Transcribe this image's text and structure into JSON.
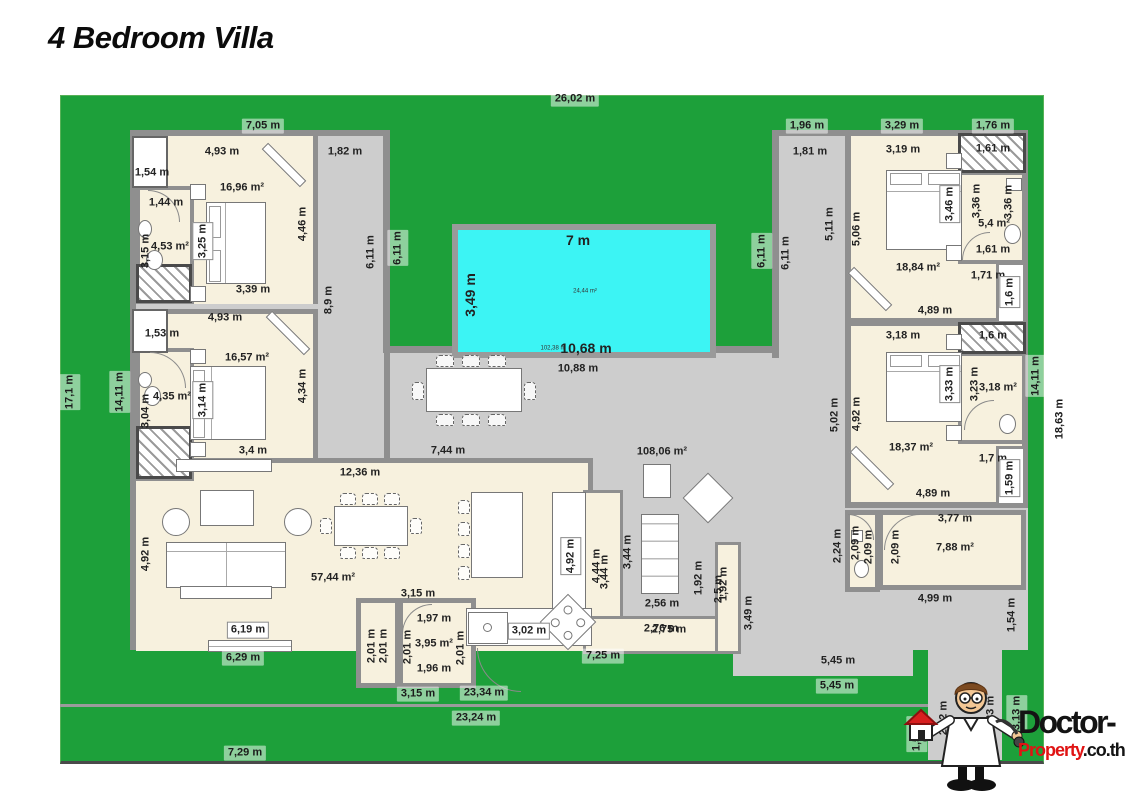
{
  "title": "4 Bedroom Villa",
  "logo": {
    "line1": "Doctor-",
    "line2_red": "Property",
    "line2_black": ".co.th"
  },
  "colors": {
    "garden": "#1da03a",
    "pool": "#3cf4f4",
    "wall": "#8f8f8f",
    "floor": "#f7f1de",
    "deck": "#cdcdcd",
    "logo_red": "#e01313"
  },
  "labels": [
    {
      "t": "26,02 m",
      "x": 575,
      "y": 99,
      "s": "chip"
    },
    {
      "t": "7,05 m",
      "x": 263,
      "y": 126,
      "s": "chip"
    },
    {
      "t": "1,96 m",
      "x": 807,
      "y": 126,
      "s": "chip"
    },
    {
      "t": "3,29 m",
      "x": 902,
      "y": 126,
      "s": "chip"
    },
    {
      "t": "1,76 m",
      "x": 993,
      "y": 126,
      "s": "chip"
    },
    {
      "t": "4,93 m",
      "x": 222,
      "y": 152
    },
    {
      "t": "1,82 m",
      "x": 345,
      "y": 152
    },
    {
      "t": "1,54 m",
      "x": 152,
      "y": 173
    },
    {
      "t": "3,19 m",
      "x": 903,
      "y": 150
    },
    {
      "t": "1,61 m",
      "x": 993,
      "y": 149
    },
    {
      "t": "1,81 m",
      "x": 810,
      "y": 152
    },
    {
      "t": "1,44 m",
      "x": 166,
      "y": 203
    },
    {
      "t": "16,96 m²",
      "x": 242,
      "y": 188
    },
    {
      "t": "4,53 m²",
      "x": 170,
      "y": 247
    },
    {
      "t": "3,39 m",
      "x": 253,
      "y": 290
    },
    {
      "t": "18,84 m²",
      "x": 918,
      "y": 268
    },
    {
      "t": "5,4 m²",
      "x": 994,
      "y": 224
    },
    {
      "t": "1,61 m",
      "x": 993,
      "y": 250
    },
    {
      "t": "1,71 m",
      "x": 988,
      "y": 276
    },
    {
      "t": "7 m",
      "x": 578,
      "y": 240,
      "s": "pool"
    },
    {
      "t": "24,44 m²",
      "x": 585,
      "y": 292,
      "s": "tiny"
    },
    {
      "t": "102,38 m",
      "x": 553,
      "y": 349,
      "s": "tiny"
    },
    {
      "t": "10,68 m",
      "x": 586,
      "y": 348,
      "s": "pool"
    },
    {
      "t": "10,88 m",
      "x": 578,
      "y": 369
    },
    {
      "t": "4,93 m",
      "x": 225,
      "y": 318
    },
    {
      "t": "1,53 m",
      "x": 162,
      "y": 334
    },
    {
      "t": "16,57 m²",
      "x": 247,
      "y": 358
    },
    {
      "t": "4,35 m²",
      "x": 172,
      "y": 397
    },
    {
      "t": "3,18 m",
      "x": 903,
      "y": 336
    },
    {
      "t": "1,6 m",
      "x": 993,
      "y": 336
    },
    {
      "t": "3,18 m²",
      "x": 998,
      "y": 388
    },
    {
      "t": "3,4 m",
      "x": 253,
      "y": 451
    },
    {
      "t": "18,37 m²",
      "x": 911,
      "y": 448
    },
    {
      "t": "7,44 m",
      "x": 448,
      "y": 451
    },
    {
      "t": "108,06 m²",
      "x": 662,
      "y": 452
    },
    {
      "t": "1,7 m",
      "x": 993,
      "y": 459
    },
    {
      "t": "12,36 m",
      "x": 360,
      "y": 473
    },
    {
      "t": "4,89 m",
      "x": 935,
      "y": 311
    },
    {
      "t": "4,89 m",
      "x": 933,
      "y": 494
    },
    {
      "t": "57,44 m²",
      "x": 333,
      "y": 578
    },
    {
      "t": "3,77 m",
      "x": 955,
      "y": 519
    },
    {
      "t": "7,88 m²",
      "x": 955,
      "y": 548
    },
    {
      "t": "3,15 m",
      "x": 418,
      "y": 594
    },
    {
      "t": "1,97 m",
      "x": 434,
      "y": 619
    },
    {
      "t": "3,95 m²",
      "x": 434,
      "y": 644
    },
    {
      "t": "1,96 m",
      "x": 434,
      "y": 669
    },
    {
      "t": "3,02 m",
      "x": 529,
      "y": 631,
      "s": "box"
    },
    {
      "t": "2,56 m",
      "x": 662,
      "y": 604
    },
    {
      "t": "2,76 m",
      "x": 661,
      "y": 629
    },
    {
      "t": "2,75 m",
      "x": 669,
      "y": 630
    },
    {
      "t": "6,19 m",
      "x": 248,
      "y": 630,
      "s": "box"
    },
    {
      "t": "6,29 m",
      "x": 243,
      "y": 658,
      "s": "chip"
    },
    {
      "t": "4,99 m",
      "x": 935,
      "y": 599
    },
    {
      "t": "5,45 m",
      "x": 838,
      "y": 661
    },
    {
      "t": "5,45 m",
      "x": 837,
      "y": 686,
      "s": "chip"
    },
    {
      "t": "3,15 m",
      "x": 418,
      "y": 694,
      "s": "chip"
    },
    {
      "t": "23,34 m",
      "x": 484,
      "y": 693,
      "s": "chip"
    },
    {
      "t": "23,24 m",
      "x": 476,
      "y": 718,
      "s": "chip"
    },
    {
      "t": "7,25 m",
      "x": 603,
      "y": 656,
      "s": "chip"
    },
    {
      "t": "7,29 m",
      "x": 245,
      "y": 753,
      "s": "chip"
    },
    {
      "t": "17,1 m",
      "x": 70,
      "y": 392,
      "v": true,
      "s": "chip"
    },
    {
      "t": "14,11 m",
      "x": 120,
      "y": 392,
      "v": true,
      "s": "chip"
    },
    {
      "t": "3,15 m",
      "x": 146,
      "y": 251,
      "v": true
    },
    {
      "t": "3,25 m",
      "x": 203,
      "y": 241,
      "v": true,
      "s": "box"
    },
    {
      "t": "4,46 m",
      "x": 303,
      "y": 224,
      "v": true
    },
    {
      "t": "8,9 m",
      "x": 329,
      "y": 300,
      "v": true
    },
    {
      "t": "6,11 m",
      "x": 371,
      "y": 252,
      "v": true
    },
    {
      "t": "6,11 m",
      "x": 398,
      "y": 248,
      "v": true,
      "s": "chip"
    },
    {
      "t": "3,49 m",
      "x": 470,
      "y": 295,
      "v": true,
      "s": "pool"
    },
    {
      "t": "3,04 m",
      "x": 146,
      "y": 411,
      "v": true
    },
    {
      "t": "3,14 m",
      "x": 203,
      "y": 400,
      "v": true,
      "s": "box"
    },
    {
      "t": "4,34 m",
      "x": 303,
      "y": 386,
      "v": true
    },
    {
      "t": "4,92 m",
      "x": 146,
      "y": 554,
      "v": true
    },
    {
      "t": "4,92 m",
      "x": 571,
      "y": 556,
      "v": true,
      "s": "box"
    },
    {
      "t": "4,44 m",
      "x": 597,
      "y": 566,
      "v": true
    },
    {
      "t": "3,44 m",
      "x": 605,
      "y": 572,
      "v": true
    },
    {
      "t": "3,44 m",
      "x": 628,
      "y": 552,
      "v": true
    },
    {
      "t": "1,92 m",
      "x": 699,
      "y": 578,
      "v": true
    },
    {
      "t": "2,5 m",
      "x": 719,
      "y": 589,
      "v": true
    },
    {
      "t": "1,92 m",
      "x": 724,
      "y": 584,
      "v": true
    },
    {
      "t": "3,49 m",
      "x": 749,
      "y": 613,
      "v": true
    },
    {
      "t": "6,11 m",
      "x": 762,
      "y": 251,
      "v": true,
      "s": "chip"
    },
    {
      "t": "6,11 m",
      "x": 786,
      "y": 253,
      "v": true
    },
    {
      "t": "5,11 m",
      "x": 830,
      "y": 224,
      "v": true
    },
    {
      "t": "5,06 m",
      "x": 857,
      "y": 229,
      "v": true
    },
    {
      "t": "3,46 m",
      "x": 950,
      "y": 204,
      "v": true,
      "s": "box"
    },
    {
      "t": "3,36 m",
      "x": 977,
      "y": 201,
      "v": true
    },
    {
      "t": "3,36 m",
      "x": 1009,
      "y": 202,
      "v": true
    },
    {
      "t": "1,6 m",
      "x": 1010,
      "y": 292,
      "v": true,
      "s": "box"
    },
    {
      "t": "5,02 m",
      "x": 835,
      "y": 415,
      "v": true
    },
    {
      "t": "4,92 m",
      "x": 857,
      "y": 414,
      "v": true
    },
    {
      "t": "3,33 m",
      "x": 950,
      "y": 384,
      "v": true,
      "s": "box"
    },
    {
      "t": "3,23 m",
      "x": 975,
      "y": 384,
      "v": true
    },
    {
      "t": "14,11 m",
      "x": 1036,
      "y": 376,
      "v": true,
      "s": "chip"
    },
    {
      "t": "18,63 m",
      "x": 1060,
      "y": 419,
      "v": true,
      "s": "chip"
    },
    {
      "t": "1,59 m",
      "x": 1010,
      "y": 478,
      "v": true,
      "s": "box"
    },
    {
      "t": "2,24 m",
      "x": 838,
      "y": 546,
      "v": true
    },
    {
      "t": "2,09 m",
      "x": 856,
      "y": 543,
      "v": true
    },
    {
      "t": "2,09 m",
      "x": 869,
      "y": 547,
      "v": true
    },
    {
      "t": "2,09 m",
      "x": 896,
      "y": 547,
      "v": true
    },
    {
      "t": "2,01 m",
      "x": 372,
      "y": 646,
      "v": true
    },
    {
      "t": "2,01 m",
      "x": 384,
      "y": 646,
      "v": true
    },
    {
      "t": "2,01 m",
      "x": 408,
      "y": 647,
      "v": true
    },
    {
      "t": "2,01 m",
      "x": 461,
      "y": 648,
      "v": true
    },
    {
      "t": "1,54 m",
      "x": 1012,
      "y": 615,
      "v": true
    },
    {
      "t": "1,53 m",
      "x": 917,
      "y": 734,
      "v": true,
      "s": "chip"
    },
    {
      "t": "2,42 m",
      "x": 944,
      "y": 718,
      "v": true
    },
    {
      "t": "3,23 m",
      "x": 991,
      "y": 713,
      "v": true
    },
    {
      "t": "3,13 m",
      "x": 1017,
      "y": 713,
      "v": true,
      "s": "chip"
    }
  ]
}
